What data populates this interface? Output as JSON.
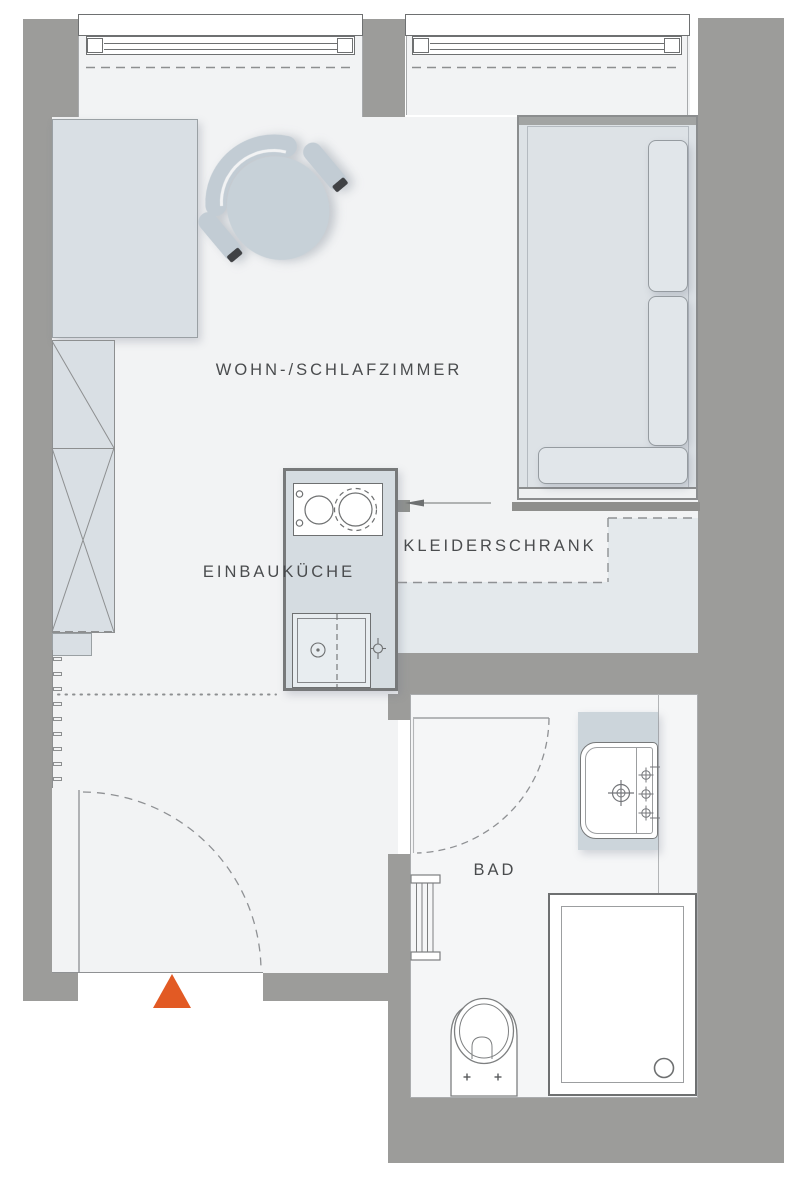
{
  "title": "Apartment floor plan",
  "palette": {
    "wall": "#9c9c9a",
    "floor": "#f2f3f4",
    "furniture": "#d9dfe4",
    "kitchen_block": "#d5dce1",
    "wardrobe_zone": "#e4e9ec",
    "bed_fill": "#dde2e6",
    "bath_floor": "#f5f6f7",
    "counter": "#ccd5db",
    "accent": "#e25a24",
    "line": "#6e7071",
    "text": "#4a4c4e"
  },
  "rooms": {
    "living_bedroom": {
      "label": "WOHN-/SCHLAFZIMMER"
    },
    "kitchen": {
      "label": "EINBAUKÜCHE"
    },
    "wardrobe": {
      "label": "KLEIDERSCHRANK"
    },
    "bathroom": {
      "label": "BAD"
    }
  },
  "markers": {
    "entrance": {
      "shape": "triangle-up",
      "color": "#e25a24"
    }
  },
  "fixtures": [
    "window",
    "window",
    "armchair",
    "desk",
    "tall-cabinet",
    "radiator",
    "cooktop",
    "kitchen-sink",
    "bed-with-cushions",
    "wardrobe-zone",
    "washbasin",
    "shower",
    "toilet",
    "towel-radiator",
    "entrance-door-swing",
    "bathroom-door-swing"
  ]
}
